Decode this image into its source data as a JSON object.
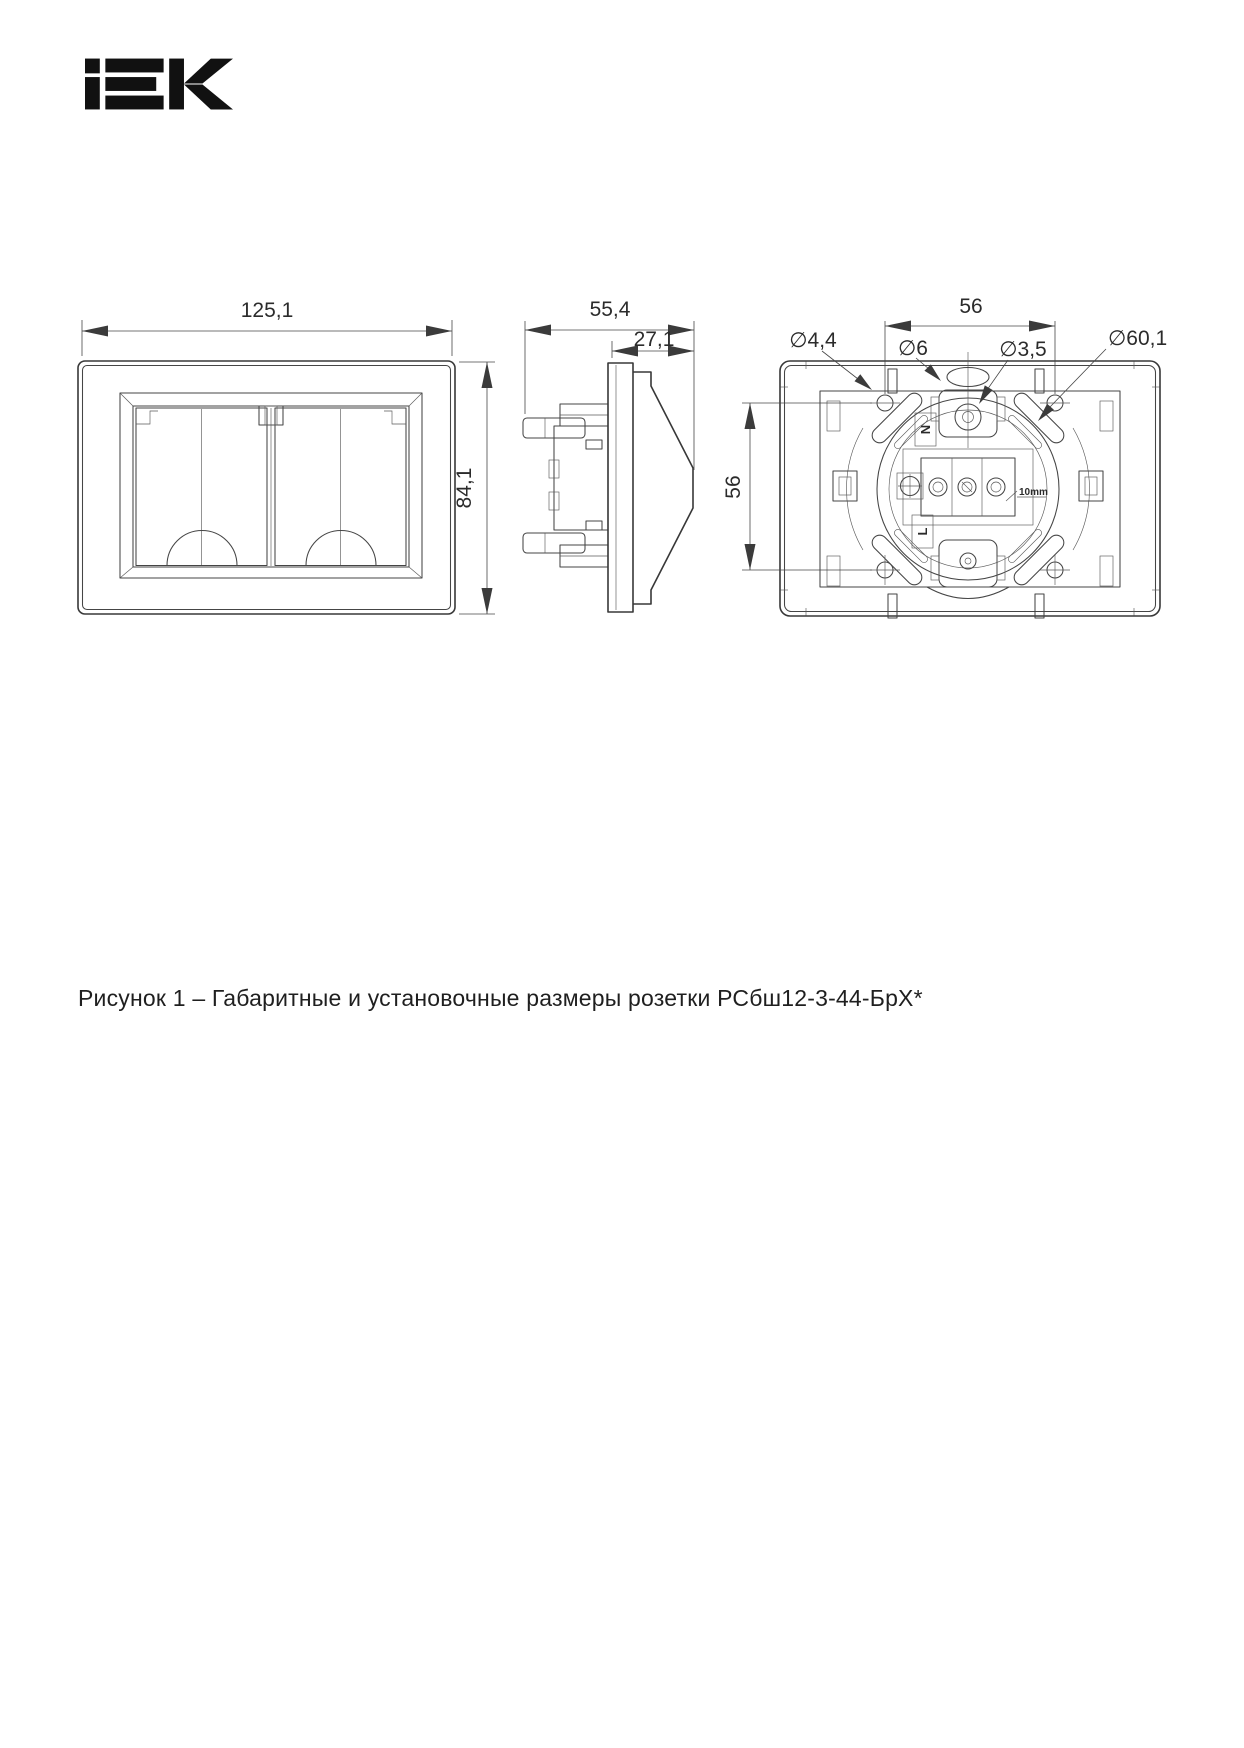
{
  "logo": {
    "brand": "IEK"
  },
  "caption": {
    "text": "Рисунок 1 – Габаритные и установочные размеры розетки РСбш12-3-44-БрХ*"
  },
  "views": {
    "front": {
      "width": "125,1",
      "height": "84,1"
    },
    "side": {
      "depth": "55,4",
      "front_depth": "27,1"
    },
    "back": {
      "mount_spacing_horizontal": "56",
      "mount_spacing_vertical": "56",
      "dia_claw_hole": "∅4,4",
      "dia_slot": "∅6",
      "dia_screw": "∅3,5",
      "dia_mechanism": "∅60,1",
      "strip_length": "10mm",
      "terminal_neutral": "N",
      "terminal_line": "L"
    }
  }
}
